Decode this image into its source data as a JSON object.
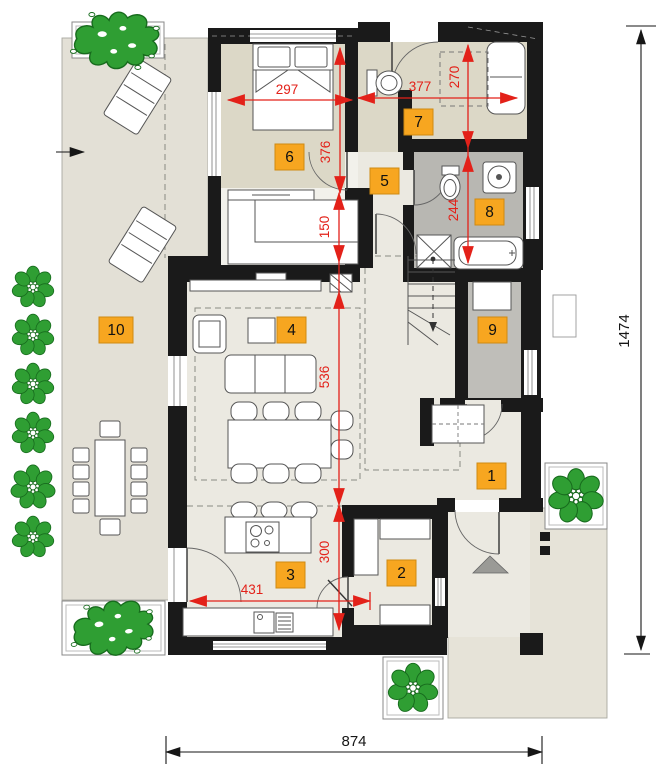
{
  "plan": {
    "title": "house ground floor plan",
    "room_labels": {
      "r1": "1",
      "r2": "2",
      "r3": "3",
      "r4": "4",
      "r5": "5",
      "r6": "6",
      "r7": "7",
      "r8": "8",
      "r9": "9",
      "r10": "10"
    },
    "dimensions": {
      "d297": "297",
      "d377": "377",
      "d270": "270",
      "d376": "376",
      "d150": "150",
      "d244": "244",
      "d536": "536",
      "d300": "300",
      "d431": "431",
      "d874": "874",
      "d1474": "1474"
    },
    "colors": {
      "wall_black": "#1a1a1a",
      "dimension_red": "#e32119",
      "label_orange": "#f7a620",
      "floor_light": "#ebe9e1",
      "floor_dark": "#dcd8c7",
      "floor_gray": "#b8b7b2",
      "terrace": "#e3e0d6",
      "paving": "#e6e3d8",
      "tree_green": "#2f9e33"
    }
  }
}
